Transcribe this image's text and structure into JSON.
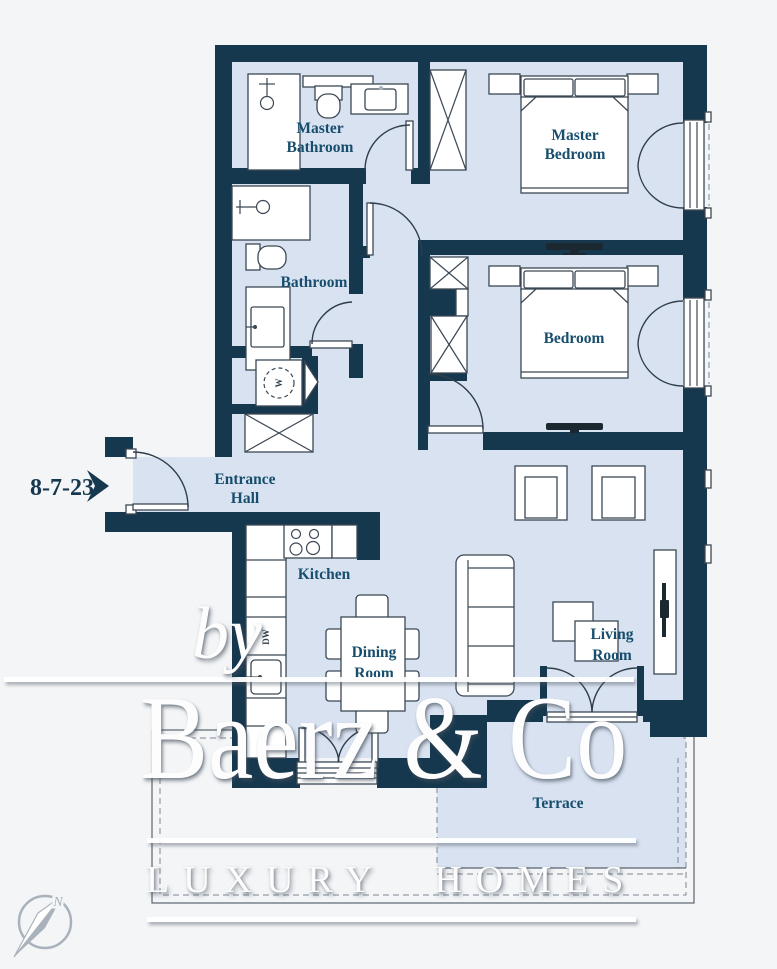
{
  "brand": {
    "by": "by",
    "name": "Baerz & Co",
    "tagline": "LUXURY HOMES"
  },
  "floorplan": {
    "unit_label": "8-7-23",
    "rooms": [
      {
        "id": "master-bathroom",
        "line1": "Master",
        "line2": "Bathroom"
      },
      {
        "id": "master-bedroom",
        "line1": "Master",
        "line2": "Bedroom"
      },
      {
        "id": "bathroom",
        "line1": "Bathroom",
        "line2": ""
      },
      {
        "id": "bedroom",
        "line1": "Bedroom",
        "line2": ""
      },
      {
        "id": "entrance-hall",
        "line1": "Entrance",
        "line2": "Hall"
      },
      {
        "id": "kitchen",
        "line1": "Kitchen",
        "line2": ""
      },
      {
        "id": "dining-room",
        "line1": "Dining",
        "line2": "Room"
      },
      {
        "id": "living-room",
        "line1": "Living",
        "line2": "Room"
      },
      {
        "id": "terrace",
        "line1": "Terrace",
        "line2": ""
      }
    ],
    "appliances": {
      "washer": "W",
      "dishwasher": "DW"
    },
    "compass_north": "N"
  },
  "colors": {
    "wall": "#16384e",
    "room_fill": "#d9e2f1",
    "background": "#f3f5f7",
    "label_text": "#174e6d",
    "furniture_stroke": "#3b4754",
    "watermark": "#ffffff",
    "compass": "#a9b2bb"
  }
}
